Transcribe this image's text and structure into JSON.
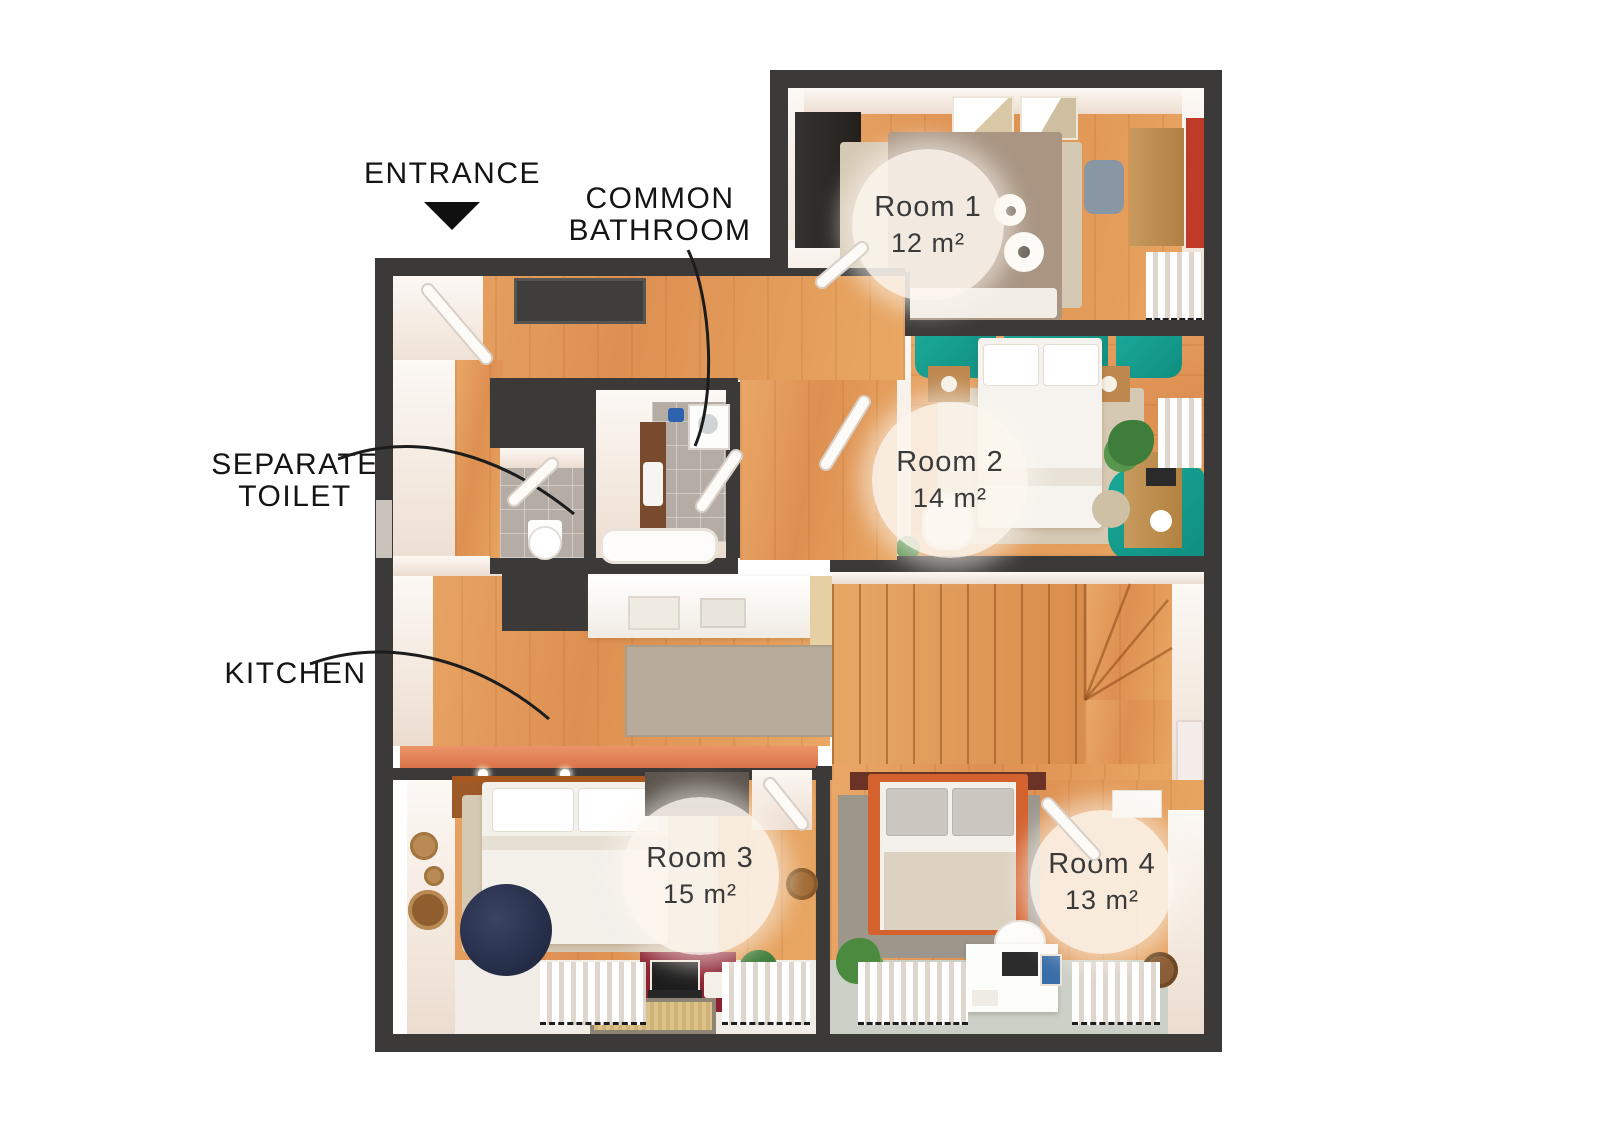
{
  "title": "Apartment floor plan with four rooms",
  "labels": {
    "entrance": "ENTRANCE",
    "common_bathroom": [
      "COMMON",
      "BATHROOM"
    ],
    "separate_toilet": [
      "SEPARATE",
      "TOILET"
    ],
    "kitchen": "KITCHEN"
  },
  "rooms": [
    {
      "name": "Room 1",
      "area": "12 m²"
    },
    {
      "name": "Room 2",
      "area": "14 m²"
    },
    {
      "name": "Room 3",
      "area": "15 m²"
    },
    {
      "name": "Room 4",
      "area": "13 m²"
    }
  ],
  "colors": {
    "wall": "#3b3a39",
    "wood_floor": "#e0975a",
    "teal_accent": "#16a191",
    "red_accent_wall": "#bf3a28",
    "maroon_sofa": "#8c2131",
    "navy_pouf": "#2c3550",
    "badge_background": "rgba(252,246,238,0.9)",
    "label_text": "#141414"
  }
}
